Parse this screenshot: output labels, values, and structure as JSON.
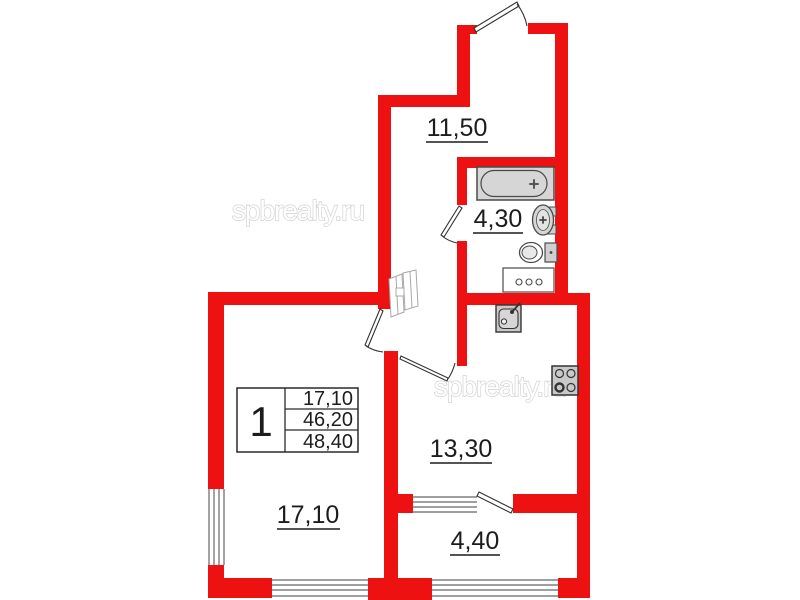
{
  "watermark": "spbrealty.ru",
  "colors": {
    "wall": "#ee1111",
    "fixture_fill": "#d6d6d6",
    "fixture_stroke": "#4a4a4a",
    "label_text": "#1c1c1c",
    "watermark_outline": "#d2d2d2"
  },
  "rooms": {
    "hallway": {
      "label": "11,50"
    },
    "bathroom": {
      "label": "4,30"
    },
    "kitchen": {
      "label": "13,30"
    },
    "living": {
      "label": "17,10"
    },
    "balcony": {
      "label": "4,40"
    }
  },
  "info_table": {
    "rooms_count": "1",
    "living_area": "17,10",
    "apartment_area": "46,20",
    "total_area": "48,40"
  }
}
